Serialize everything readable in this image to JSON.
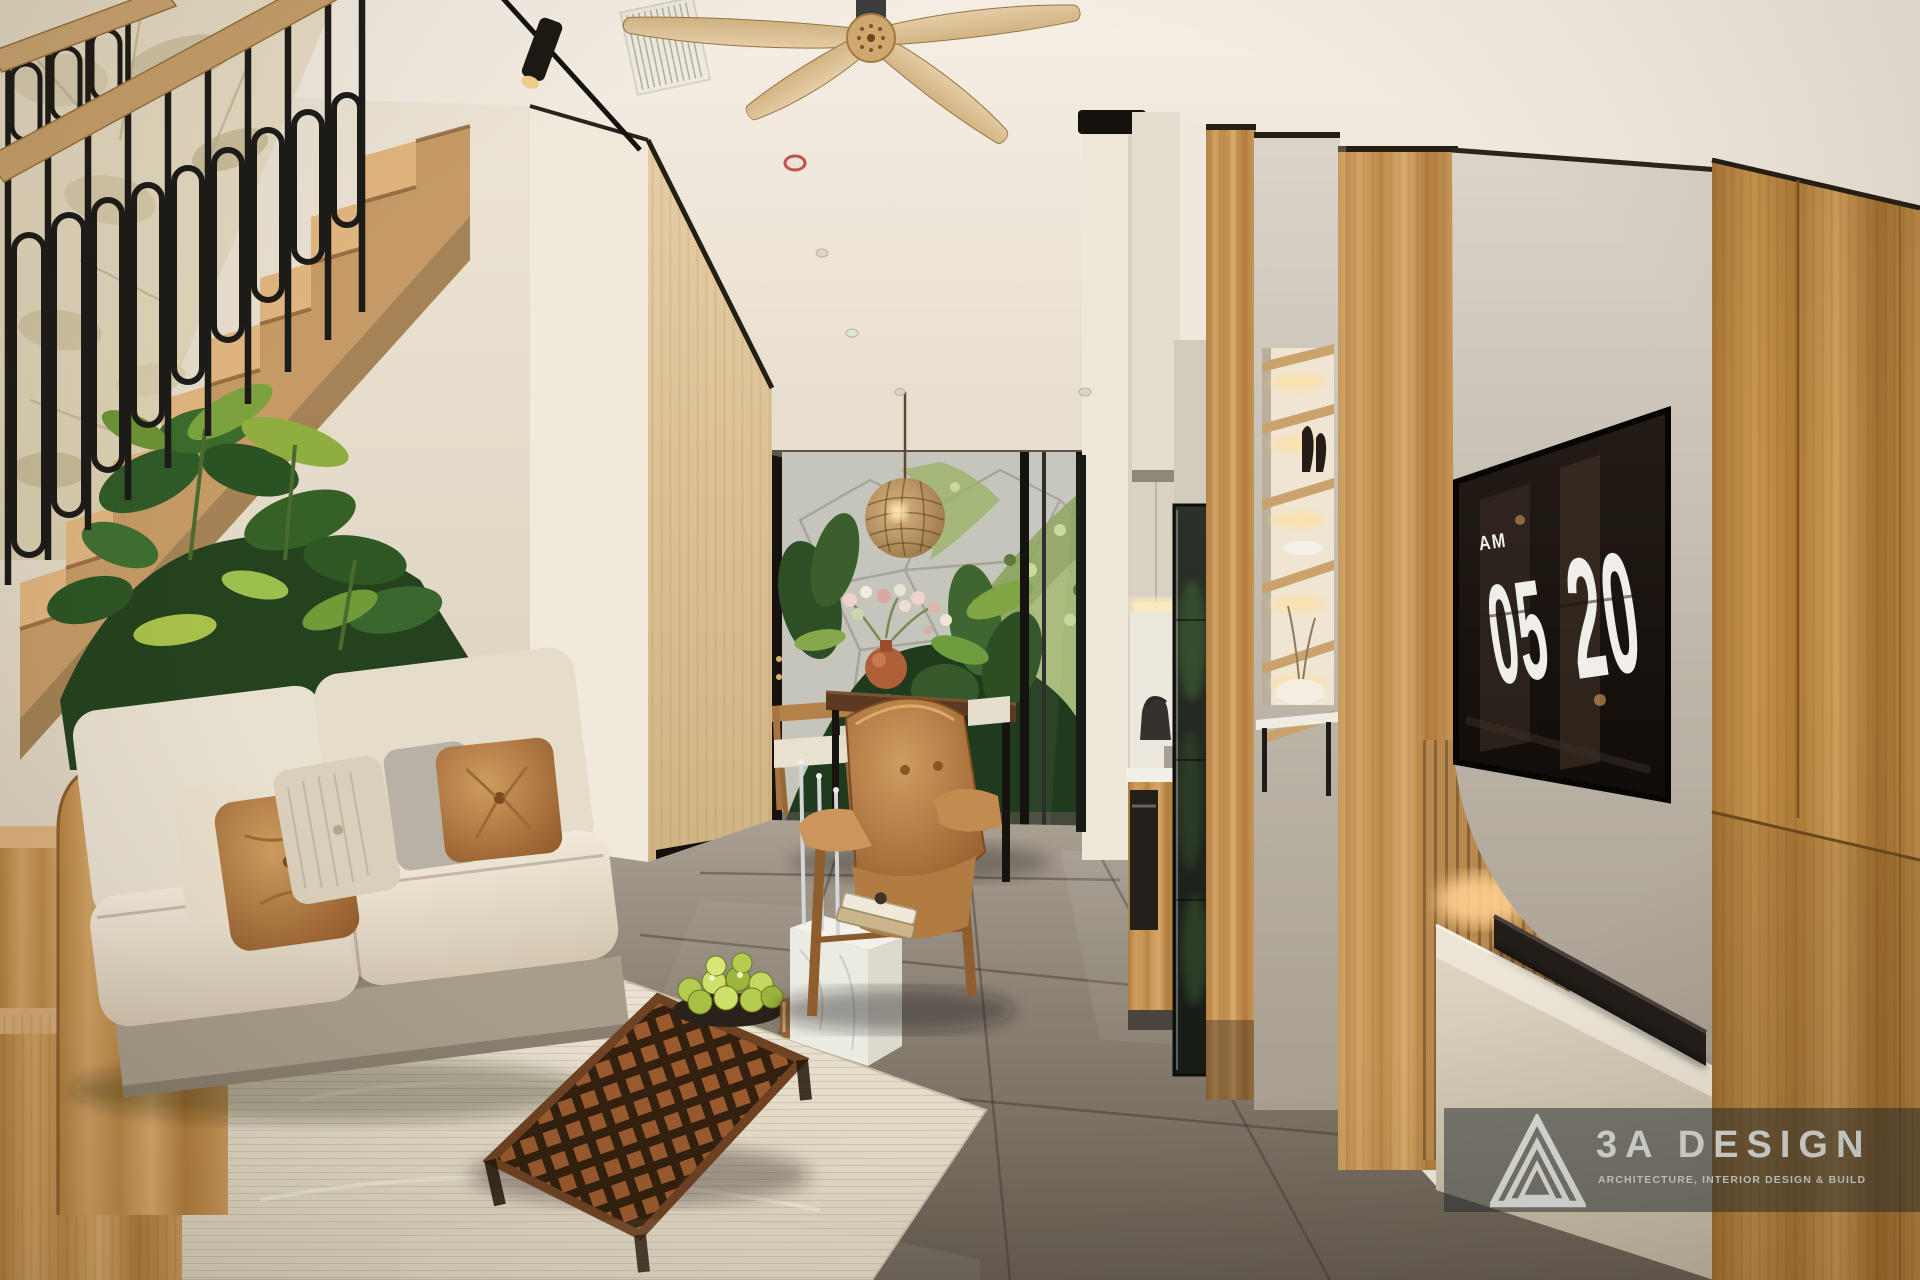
{
  "tv_clock": {
    "meridiem": "AM",
    "hours": "05",
    "minutes": "20"
  },
  "watermark": {
    "brand": "3A DESIGN",
    "tagline": "ARCHITECTURE, INTERIOR DESIGN & BUILD",
    "logo_icon": "triangle-logo-icon"
  },
  "palette": {
    "ceiling": "#f2ece2",
    "wall_cream": "#ece4d5",
    "stone_wall": "#e9dfc6",
    "wood_oak": "#c9995f",
    "wood_rich": "#b5824a",
    "railing_black": "#1d1b18",
    "plant_green_dark": "#2f5626",
    "plant_green_light": "#9fbf49",
    "sofa_cream": "#ece4d3",
    "leather_cognac": "#b5854f",
    "floor_stone": "#847b6f",
    "rug": "#e7e0cf",
    "tv_black": "#17110d",
    "clock_text": "#efeee8",
    "gray_panel": "#c9c2b6",
    "logo_text": "#d3d4d0"
  }
}
